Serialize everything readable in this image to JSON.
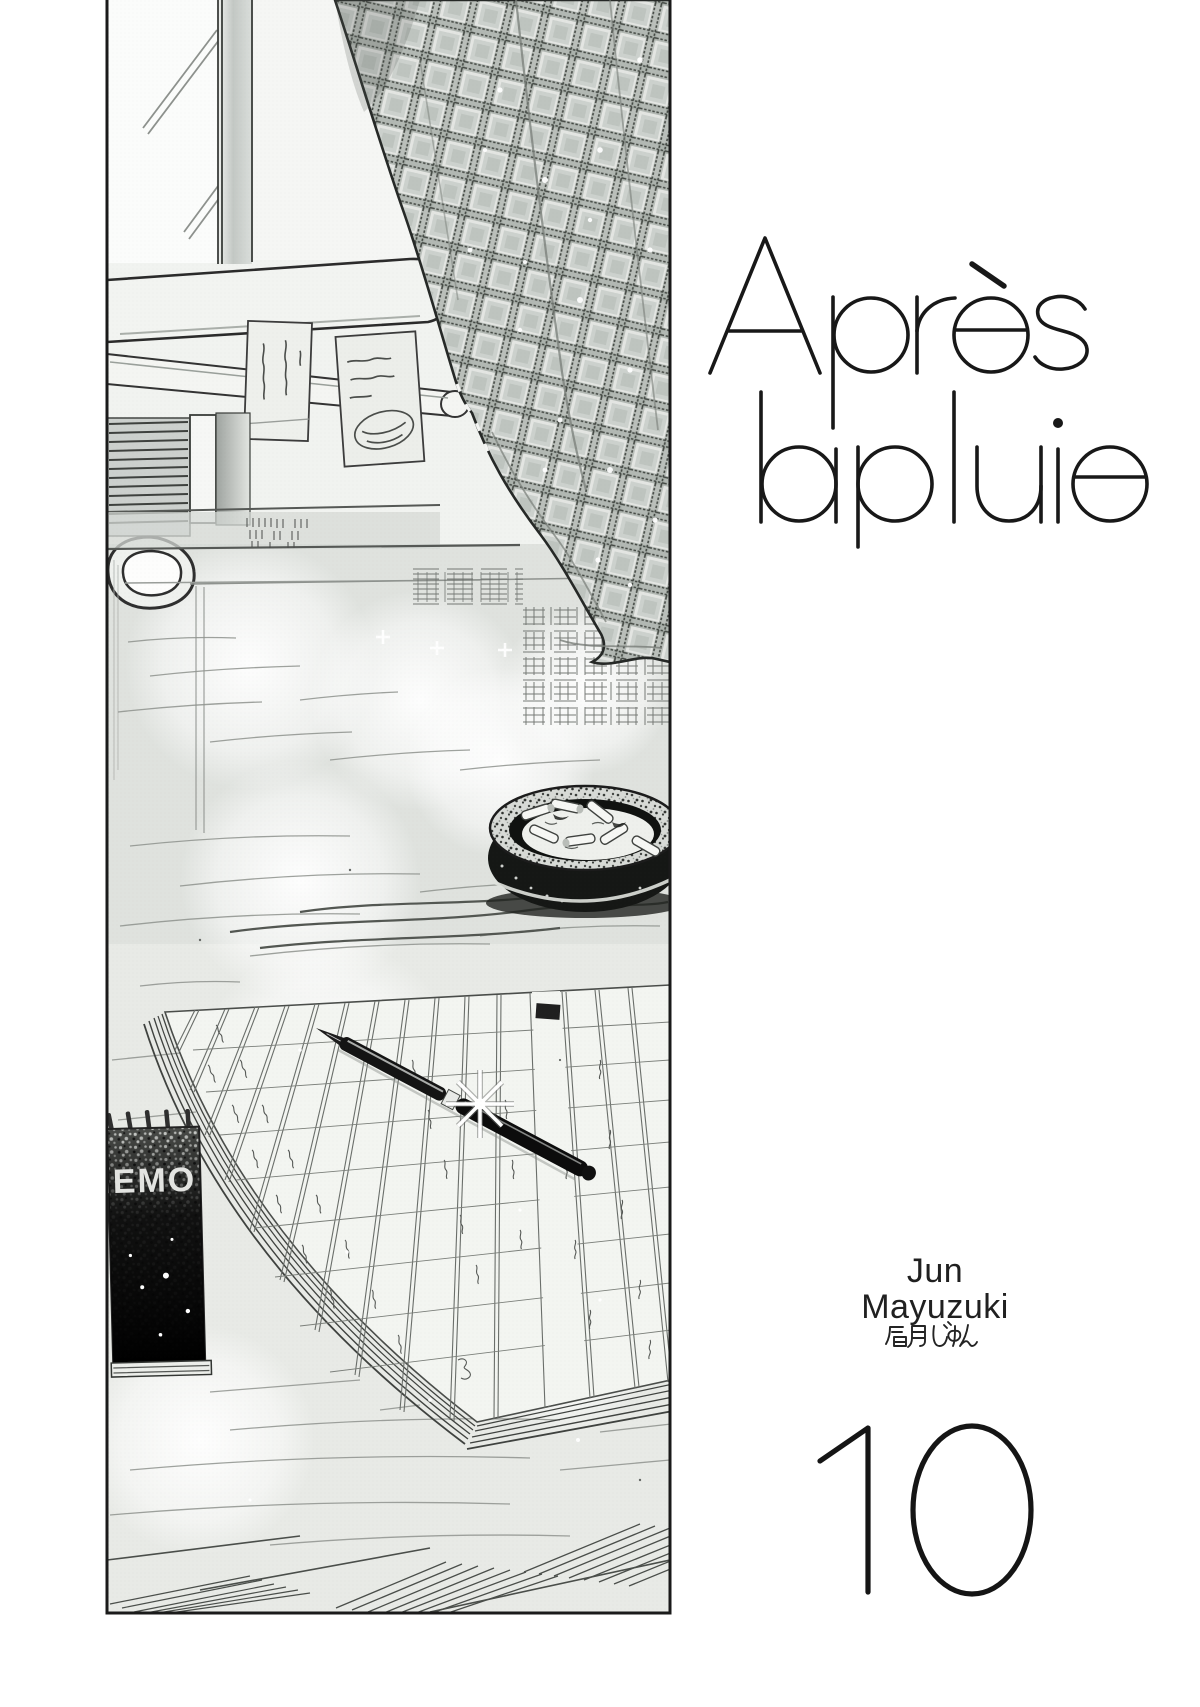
{
  "title": {
    "line1": "Après",
    "line2": "la pluie"
  },
  "author": {
    "romanized_line1": "Jun",
    "romanized_line2": "Mayuzuki",
    "kanji": "眉月じゅん"
  },
  "volume": {
    "number": "10"
  },
  "illustration": {
    "memo_pad_label": "MEMO"
  },
  "colors": {
    "ink": "#1a1a1a",
    "paper": "#ffffff",
    "tone_gray": "#dfe2de"
  }
}
